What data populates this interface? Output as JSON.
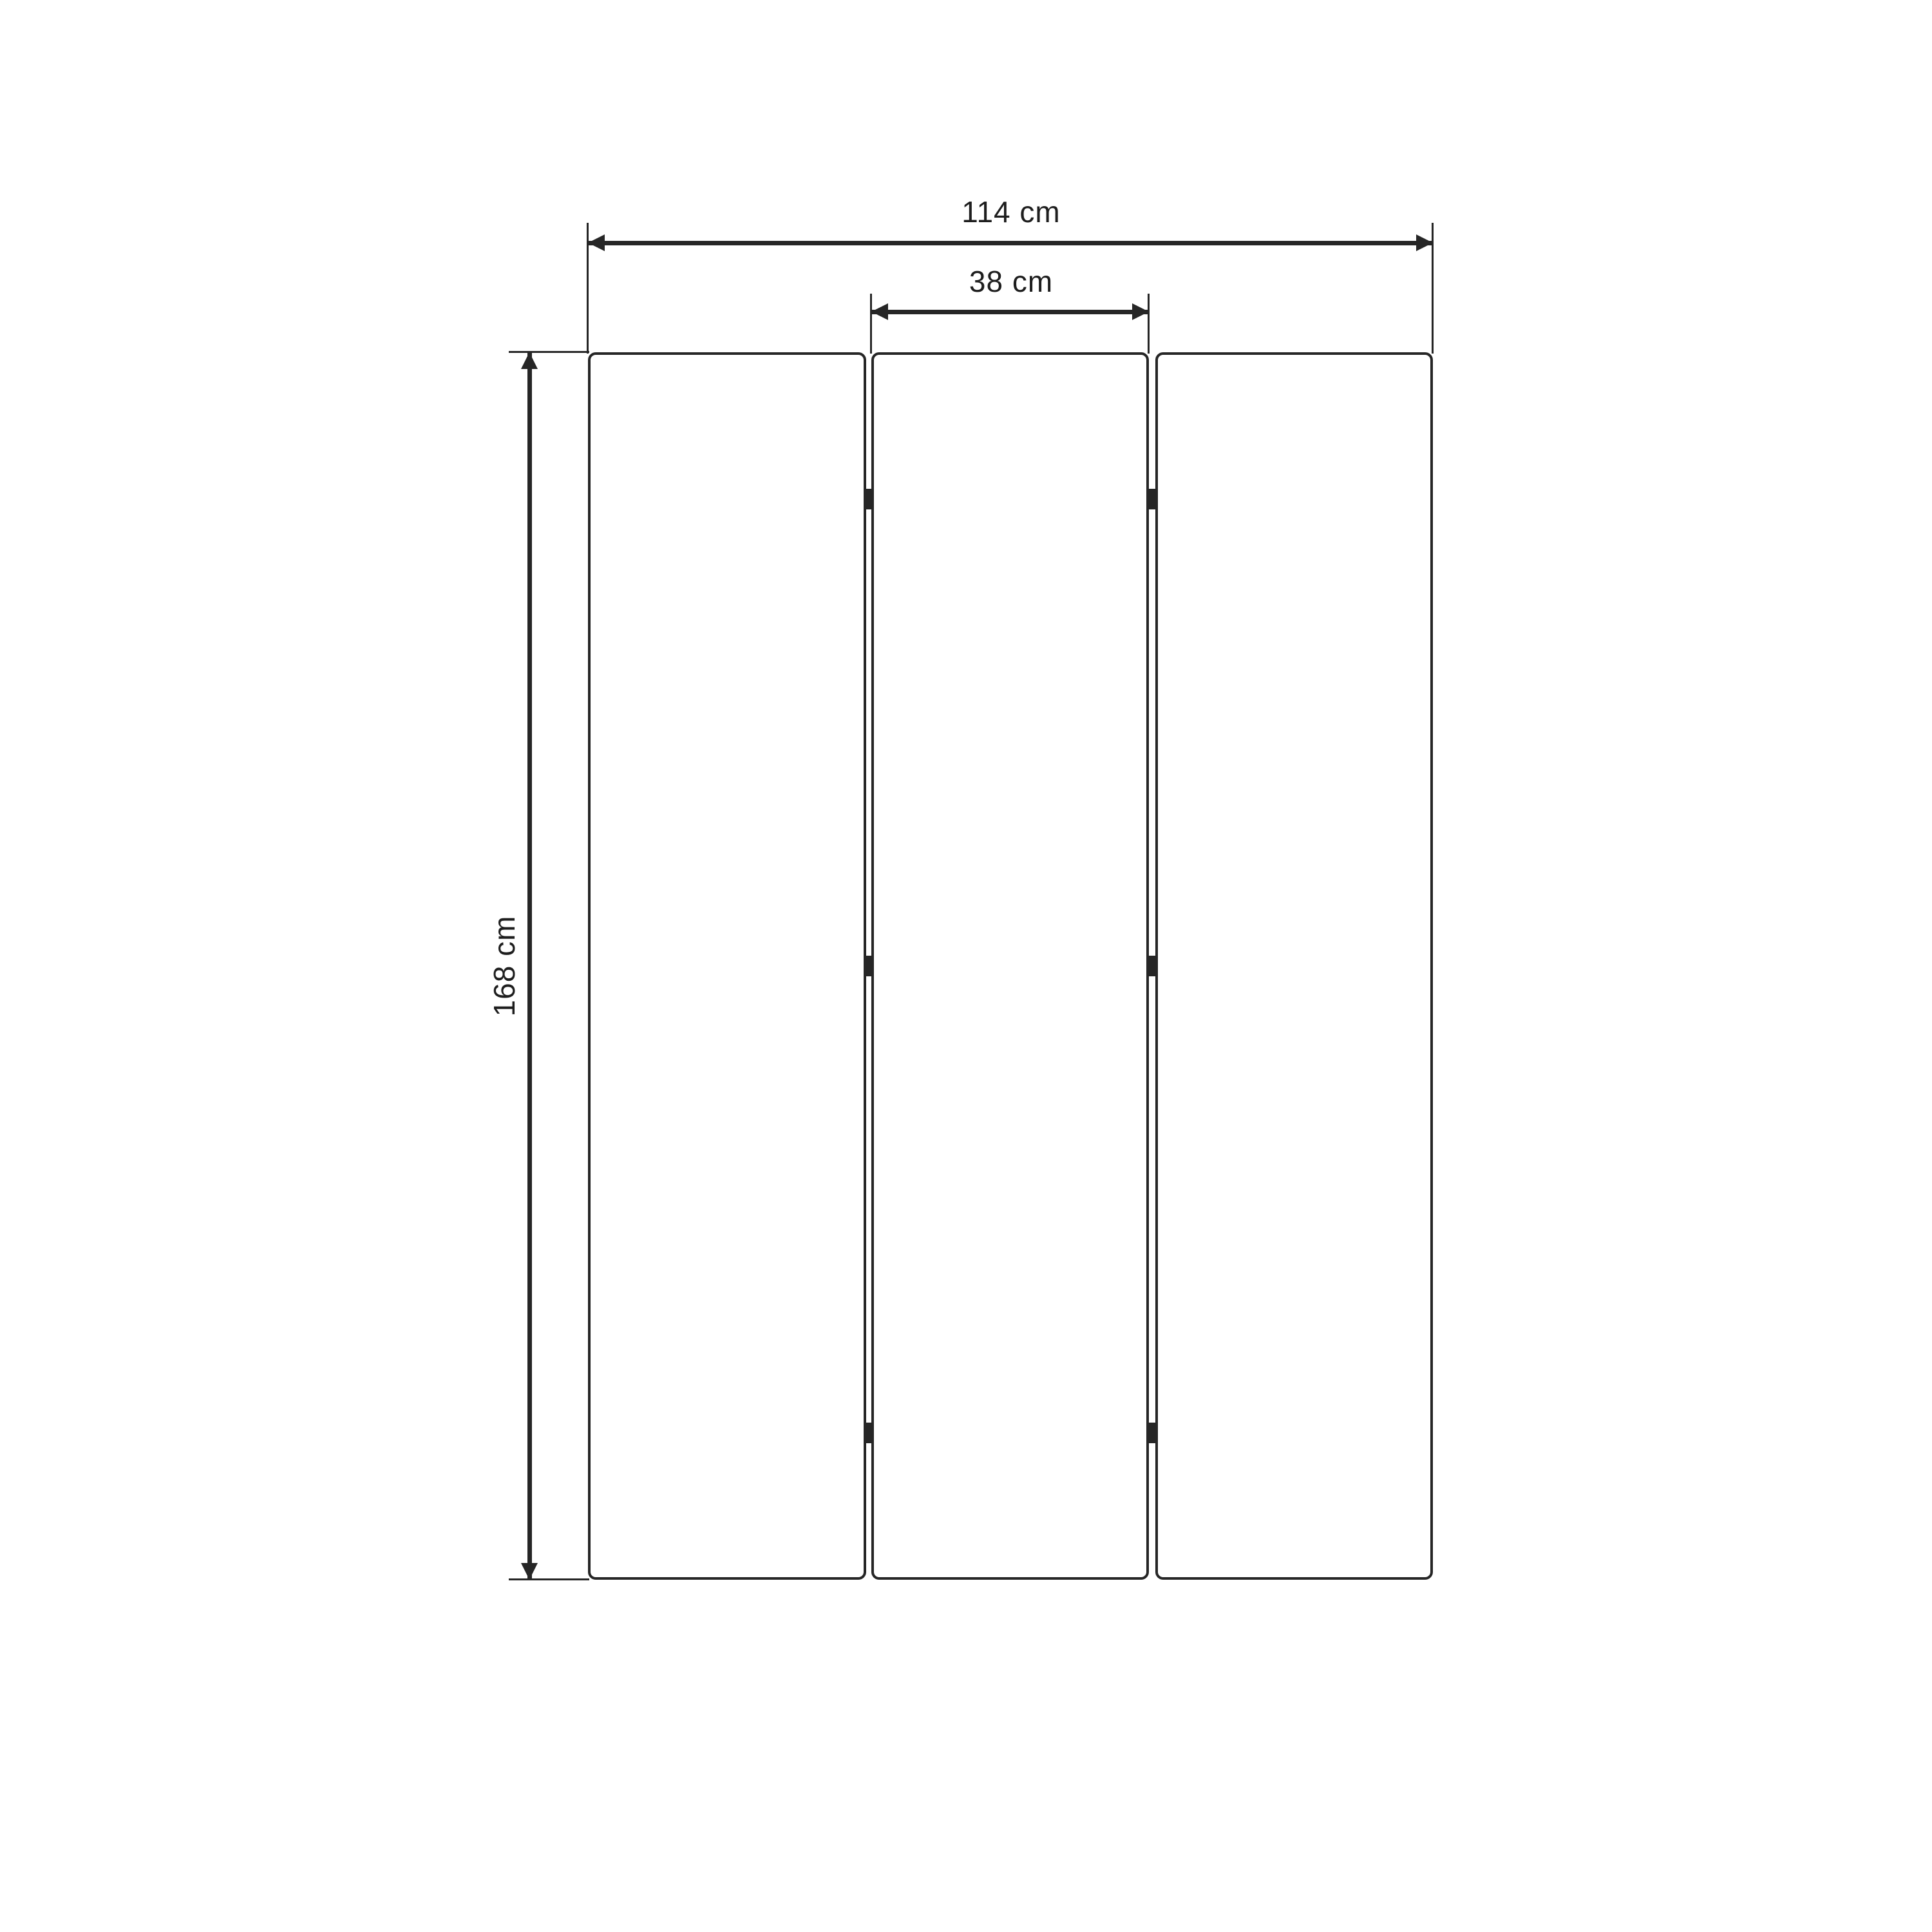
{
  "diagram": {
    "type": "panel-screen-dimension-drawing",
    "unit": "cm",
    "dimensions": {
      "overall_width": {
        "value": 114,
        "unit": "cm",
        "label": "114 cm"
      },
      "panel_width": {
        "value": 38,
        "unit": "cm",
        "label": "38 cm"
      },
      "height": {
        "value": 168,
        "unit": "cm",
        "label": "168 cm"
      }
    },
    "panels": {
      "count": 3,
      "hinge_marks_per_gap": 3
    },
    "colors": {
      "ink": "#262626",
      "background": "#ffffff"
    }
  }
}
